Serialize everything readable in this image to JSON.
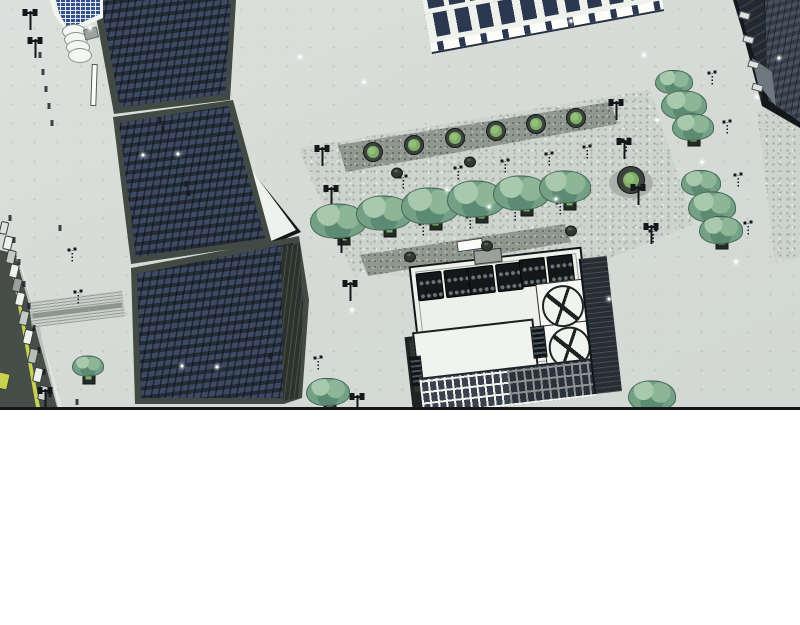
{
  "canvas": {
    "width": 800,
    "height": 625,
    "panel_height": 407,
    "page_background": "#ffffff"
  },
  "palette": {
    "pavement": "#d7dcd8",
    "plaza": "#cdd3cd",
    "band": "#8e988f",
    "road": "#454e49",
    "road_line": "#c9d24e",
    "curb": "#e6eae6",
    "outline": "#15181a",
    "tower_frame": "#414a44",
    "tower_face": "#242c37",
    "tower_window": "#3e4a63",
    "flank": "#2c332d",
    "white_roof": "#eff1ec",
    "classical_white": "#eff1ed",
    "classical_window": "#2b3850",
    "corner_face_a": "#232932",
    "corner_face_b": "#343d48",
    "corner_row": "#465260",
    "glass": "#31518c",
    "gray_wall": "#6f7780",
    "roof_white": "#eef0ec",
    "hvac": "#14181a",
    "fan": "#6a7476",
    "tank_line": "#1c2321",
    "tree_base": "#74a186",
    "tree_light": "#a9c9ae",
    "tree_dark": "#5d8a72",
    "planter_green": "#7fae68",
    "lamp": "#15181a",
    "vehicle_outline": "#3a403c",
    "manhole": "#7e867f",
    "snow": "#ffffff"
  },
  "objects": {
    "shadows": [
      [
        631,
        183,
        44,
        30
      ]
    ],
    "manhole": [
      [
        337,
        224,
        44,
        26
      ]
    ],
    "bench": [
      [
        470,
        245,
        24,
        9
      ]
    ],
    "round_planters": [
      [
        373,
        152,
        18
      ],
      [
        414,
        145,
        18
      ],
      [
        455,
        138,
        18
      ],
      [
        496,
        131,
        18
      ],
      [
        536,
        124,
        18
      ],
      [
        576,
        118,
        18
      ],
      [
        631,
        180,
        26
      ]
    ],
    "tree_planters": [
      [
        344,
        240
      ],
      [
        390,
        232
      ],
      [
        436,
        225
      ],
      [
        482,
        218
      ],
      [
        527,
        211
      ],
      [
        570,
        205
      ],
      [
        694,
        141
      ],
      [
        722,
        244
      ],
      [
        89,
        379
      ],
      [
        330,
        406
      ],
      [
        654,
        407
      ]
    ],
    "bushes": [
      [
        397,
        173
      ],
      [
        470,
        162
      ],
      [
        410,
        257
      ],
      [
        487,
        246
      ],
      [
        571,
        231
      ]
    ],
    "vehicles": [
      [
        8,
        243,
        7,
        12,
        "#eef0ee"
      ],
      [
        11,
        257,
        7,
        12,
        "#c3c9c5"
      ],
      [
        14,
        271,
        7,
        12,
        "#eef0ee"
      ],
      [
        17,
        285,
        7,
        12,
        "#9aa19c"
      ],
      [
        20,
        299,
        7,
        12,
        "#eef0ee"
      ],
      [
        24,
        318,
        7,
        13,
        "#c3c9c5"
      ],
      [
        28,
        337,
        7,
        13,
        "#eef0ee"
      ],
      [
        33,
        356,
        7,
        13,
        "#b7bdb9"
      ],
      [
        38,
        375,
        7,
        13,
        "#eef0ee"
      ],
      [
        43,
        393,
        7,
        13,
        "#d0d5d1"
      ],
      [
        3,
        381,
        10,
        15,
        "#c9d24e"
      ],
      [
        4,
        228,
        6,
        11,
        "#dfe3df"
      ]
    ],
    "bollards": [
      [
        40,
        55
      ],
      [
        43,
        72
      ],
      [
        46,
        89
      ],
      [
        49,
        106
      ],
      [
        52,
        123
      ],
      [
        10,
        218
      ],
      [
        14,
        240
      ],
      [
        19,
        262
      ],
      [
        24,
        284
      ],
      [
        29,
        306
      ],
      [
        34,
        328
      ],
      [
        39,
        350
      ],
      [
        44,
        372
      ],
      [
        50,
        394
      ],
      [
        77,
        402
      ],
      [
        60,
        228
      ],
      [
        160,
        120
      ],
      [
        163,
        129
      ],
      [
        186,
        184
      ],
      [
        189,
        193
      ],
      [
        270,
        356
      ]
    ],
    "lamps_small": [
      [
        403,
        182
      ],
      [
        458,
        173
      ],
      [
        505,
        166
      ],
      [
        549,
        159
      ],
      [
        587,
        152
      ],
      [
        423,
        229
      ],
      [
        470,
        222
      ],
      [
        515,
        214
      ],
      [
        560,
        208
      ],
      [
        318,
        363
      ],
      [
        712,
        78
      ],
      [
        727,
        127
      ],
      [
        738,
        180
      ],
      [
        748,
        228
      ],
      [
        653,
        236
      ],
      [
        626,
        145
      ],
      [
        72,
        255
      ],
      [
        78,
        297
      ]
    ],
    "lamps_twin": [
      [
        30,
        20
      ],
      [
        35,
        48
      ],
      [
        322,
        156
      ],
      [
        331,
        196
      ],
      [
        341,
        243
      ],
      [
        350,
        291
      ],
      [
        616,
        110
      ],
      [
        624,
        149
      ],
      [
        638,
        195
      ],
      [
        651,
        234
      ],
      [
        45,
        398
      ],
      [
        357,
        404
      ]
    ],
    "trees": [
      [
        338,
        221,
        54
      ],
      [
        384,
        213,
        54
      ],
      [
        430,
        206,
        56
      ],
      [
        476,
        199,
        56
      ],
      [
        521,
        193,
        54
      ],
      [
        565,
        187,
        50
      ],
      [
        674,
        82,
        36
      ],
      [
        684,
        105,
        44
      ],
      [
        693,
        127,
        40
      ],
      [
        701,
        183,
        38
      ],
      [
        712,
        207,
        46
      ],
      [
        721,
        230,
        42
      ],
      [
        88,
        366,
        30
      ],
      [
        328,
        392,
        42
      ],
      [
        652,
        396,
        46
      ]
    ],
    "snow": [
      [
        90,
        28
      ],
      [
        178,
        154
      ],
      [
        300,
        57
      ],
      [
        364,
        82
      ],
      [
        447,
        190
      ],
      [
        489,
        207
      ],
      [
        556,
        199
      ],
      [
        644,
        55
      ],
      [
        702,
        162
      ],
      [
        757,
        97
      ],
      [
        779,
        58
      ],
      [
        182,
        366
      ],
      [
        352,
        310
      ],
      [
        609,
        299
      ],
      [
        736,
        262
      ],
      [
        571,
        21
      ],
      [
        657,
        120
      ],
      [
        143,
        155
      ],
      [
        217,
        367
      ]
    ]
  }
}
